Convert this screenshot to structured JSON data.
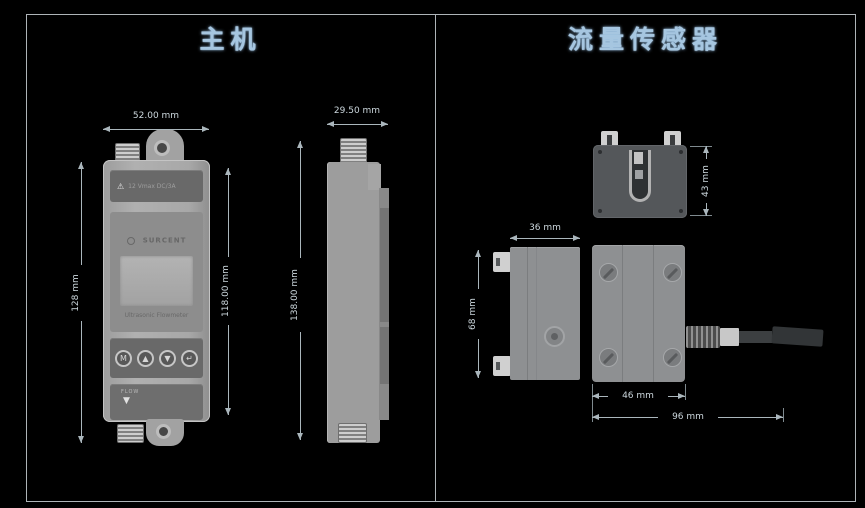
{
  "page": {
    "left_panel_title": "主机",
    "right_panel_title": "流量传感器"
  },
  "main_unit": {
    "front": {
      "brand": "SURCENT",
      "warning_icon": "⚠",
      "warning_text": "12 Vmax DC/3A",
      "product_label": "Ultrasonic Flowmeter",
      "buttons": [
        "M",
        "▲",
        "▼",
        "↵"
      ],
      "flow_label": "FLOW",
      "flow_arrow": "▼"
    },
    "dimensions": {
      "width": "52.00 mm",
      "height_outer": "128 mm",
      "height_inner": "118.00 mm",
      "depth": "29.50 mm",
      "side_height": "138.00 mm"
    }
  },
  "flow_sensor": {
    "dimensions": {
      "clamp_height": "43 mm",
      "body_depth": "36 mm",
      "body_height": "68 mm",
      "body_width": "46 mm",
      "overall_width": "96 mm"
    }
  },
  "colors": {
    "background": "#000000",
    "header_text": "#a6c6e0",
    "dimension_text": "#ccd7dd",
    "device_gray": "#a6a6a6",
    "sensor_dark": "#54575a"
  }
}
